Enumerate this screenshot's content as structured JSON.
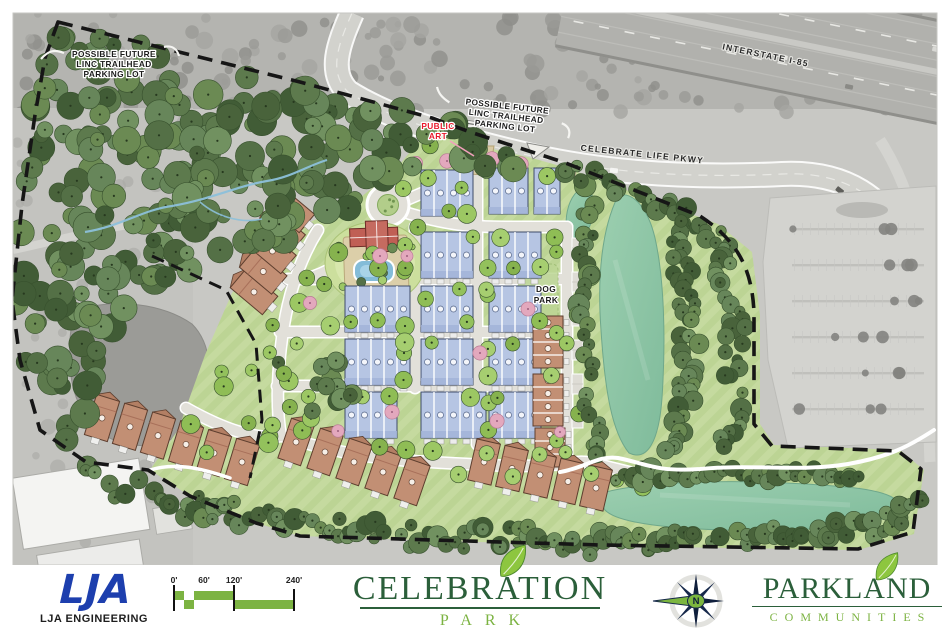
{
  "colors": {
    "lja_blue": "#1d3fae",
    "logo_green_dark": "#2b5f3a",
    "logo_green_light": "#7cb342",
    "public_art_red": "#e8192c",
    "pond_teal": "#8cc4a6",
    "lawn_green": "#c3d9a2",
    "forest_green": "#55714a",
    "roof_blue": "#b6c5e3",
    "roof_salmon": "#c28f74",
    "road_gray": "#d2d2cd",
    "boundary_black": "#161616"
  },
  "map": {
    "labels": {
      "trailhead": {
        "line1": "POSSIBLE FUTURE",
        "line2": "LINC TRAILHEAD",
        "line3": "PARKING LOT"
      },
      "public_art": {
        "line1": "PUBLIC",
        "line2": "ART"
      },
      "parkway": "CELEBRATE LIFE PKWY",
      "interstate": "INTERSTATE I-85",
      "dog_park": {
        "line1": "DOG",
        "line2": "PARK"
      }
    }
  },
  "footer": {
    "lja": {
      "mark": "LJA",
      "name": "LJA ENGINEERING"
    },
    "scale": {
      "ticks": [
        "0'",
        "60'",
        "120'",
        "240'"
      ]
    },
    "celebration": {
      "title": "CELEBRATION",
      "subtitle": "PARK"
    },
    "compass": {
      "north": "N"
    },
    "parkland": {
      "title": "PARKLAND",
      "subtitle": "COMMUNITIES"
    }
  }
}
